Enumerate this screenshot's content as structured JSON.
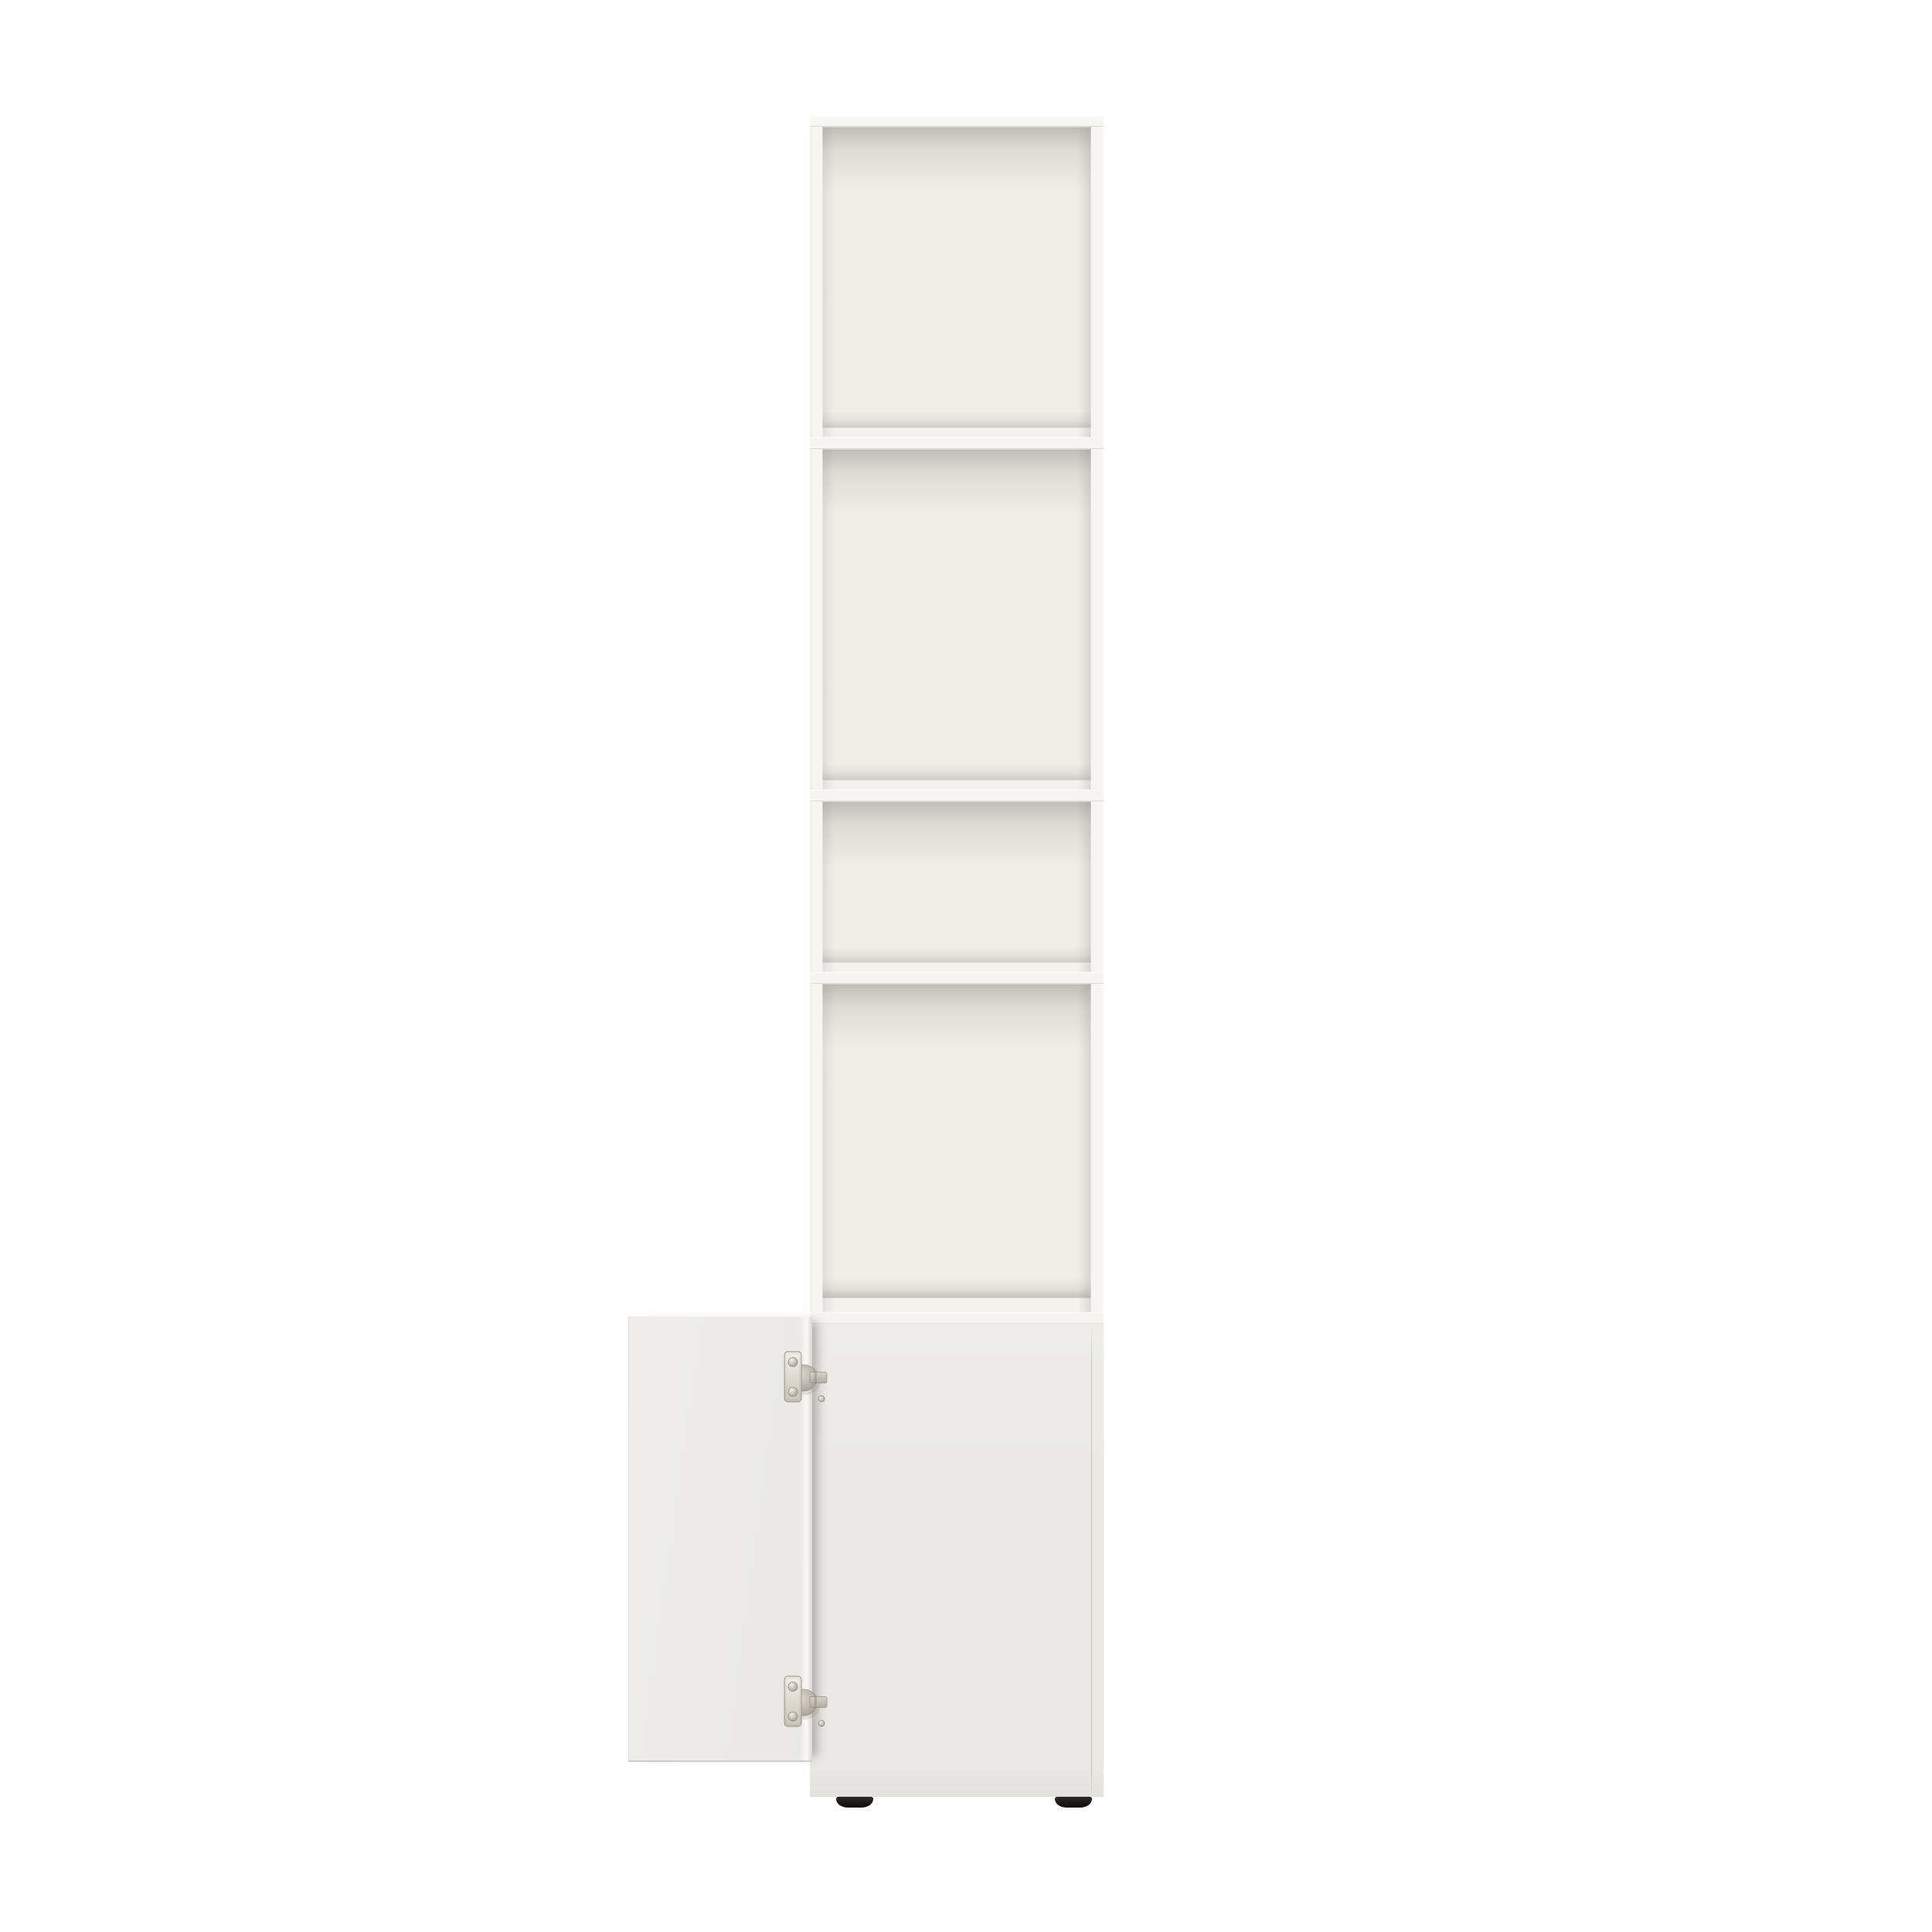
{
  "scene": {
    "description": "Studio product photo on a pure white background: a tall, narrow white storage cabinet with four open cubby compartments stacked above a lower closed cabinet whose white door is swung open to the left, revealing two satin-nickel concealed cup hinges; the unit stands on two small dark disc feet.",
    "background_color": "#ffffff"
  },
  "product": {
    "kind": "tall cabinet bookcase",
    "finish": "white",
    "open_compartment_count": 4,
    "shelf_divider_count": 3,
    "door": {
      "state": "open",
      "swing": "left",
      "hinges_visible": 2,
      "hinge_finish": "satin nickel"
    },
    "feet_visible": 2,
    "feet_color_name": "black"
  },
  "labels": {
    "scene": "white tall cabinet product photo",
    "body": "cabinet carcass",
    "top_edge": "cabinet top panel edge",
    "compartment_1": "open compartment 1",
    "compartment_2": "open compartment 2",
    "compartment_3": "open compartment 3 (short)",
    "compartment_4": "open compartment 4",
    "divider": "shelf divider",
    "floor_strip": "lower compartment floor edge",
    "bottom": "closed lower cabinet front",
    "bottom_seam": "panel seam line",
    "door": "opened cabinet door (inside face)",
    "door_edge": "door edge band",
    "hinge_top": "upper concealed hinge",
    "hinge_bottom": "lower concealed hinge",
    "foot_left": "left adjustable foot",
    "foot_right": "right adjustable foot"
  },
  "colors": {
    "bg": "#ffffff",
    "frame": "#f6f5f2",
    "frame-top": "#fbfbf9",
    "interior": "#efeee9",
    "floor": "#f3f2ee",
    "divider": "#f5f4f0",
    "bottom-panel": "#eae9e5",
    "bottom-panel-top": "#edece8",
    "door": "#ebeae6",
    "door-edge": "#d8d6d1",
    "seam": "#97958f",
    "foot-dark": "#141312",
    "foot-light": "#2e2c29",
    "hinge-light": "#e9e6df",
    "hinge-mid": "#c3beb5",
    "hinge-dark": "#a39e95",
    "hinge-edge": "#968f86"
  }
}
